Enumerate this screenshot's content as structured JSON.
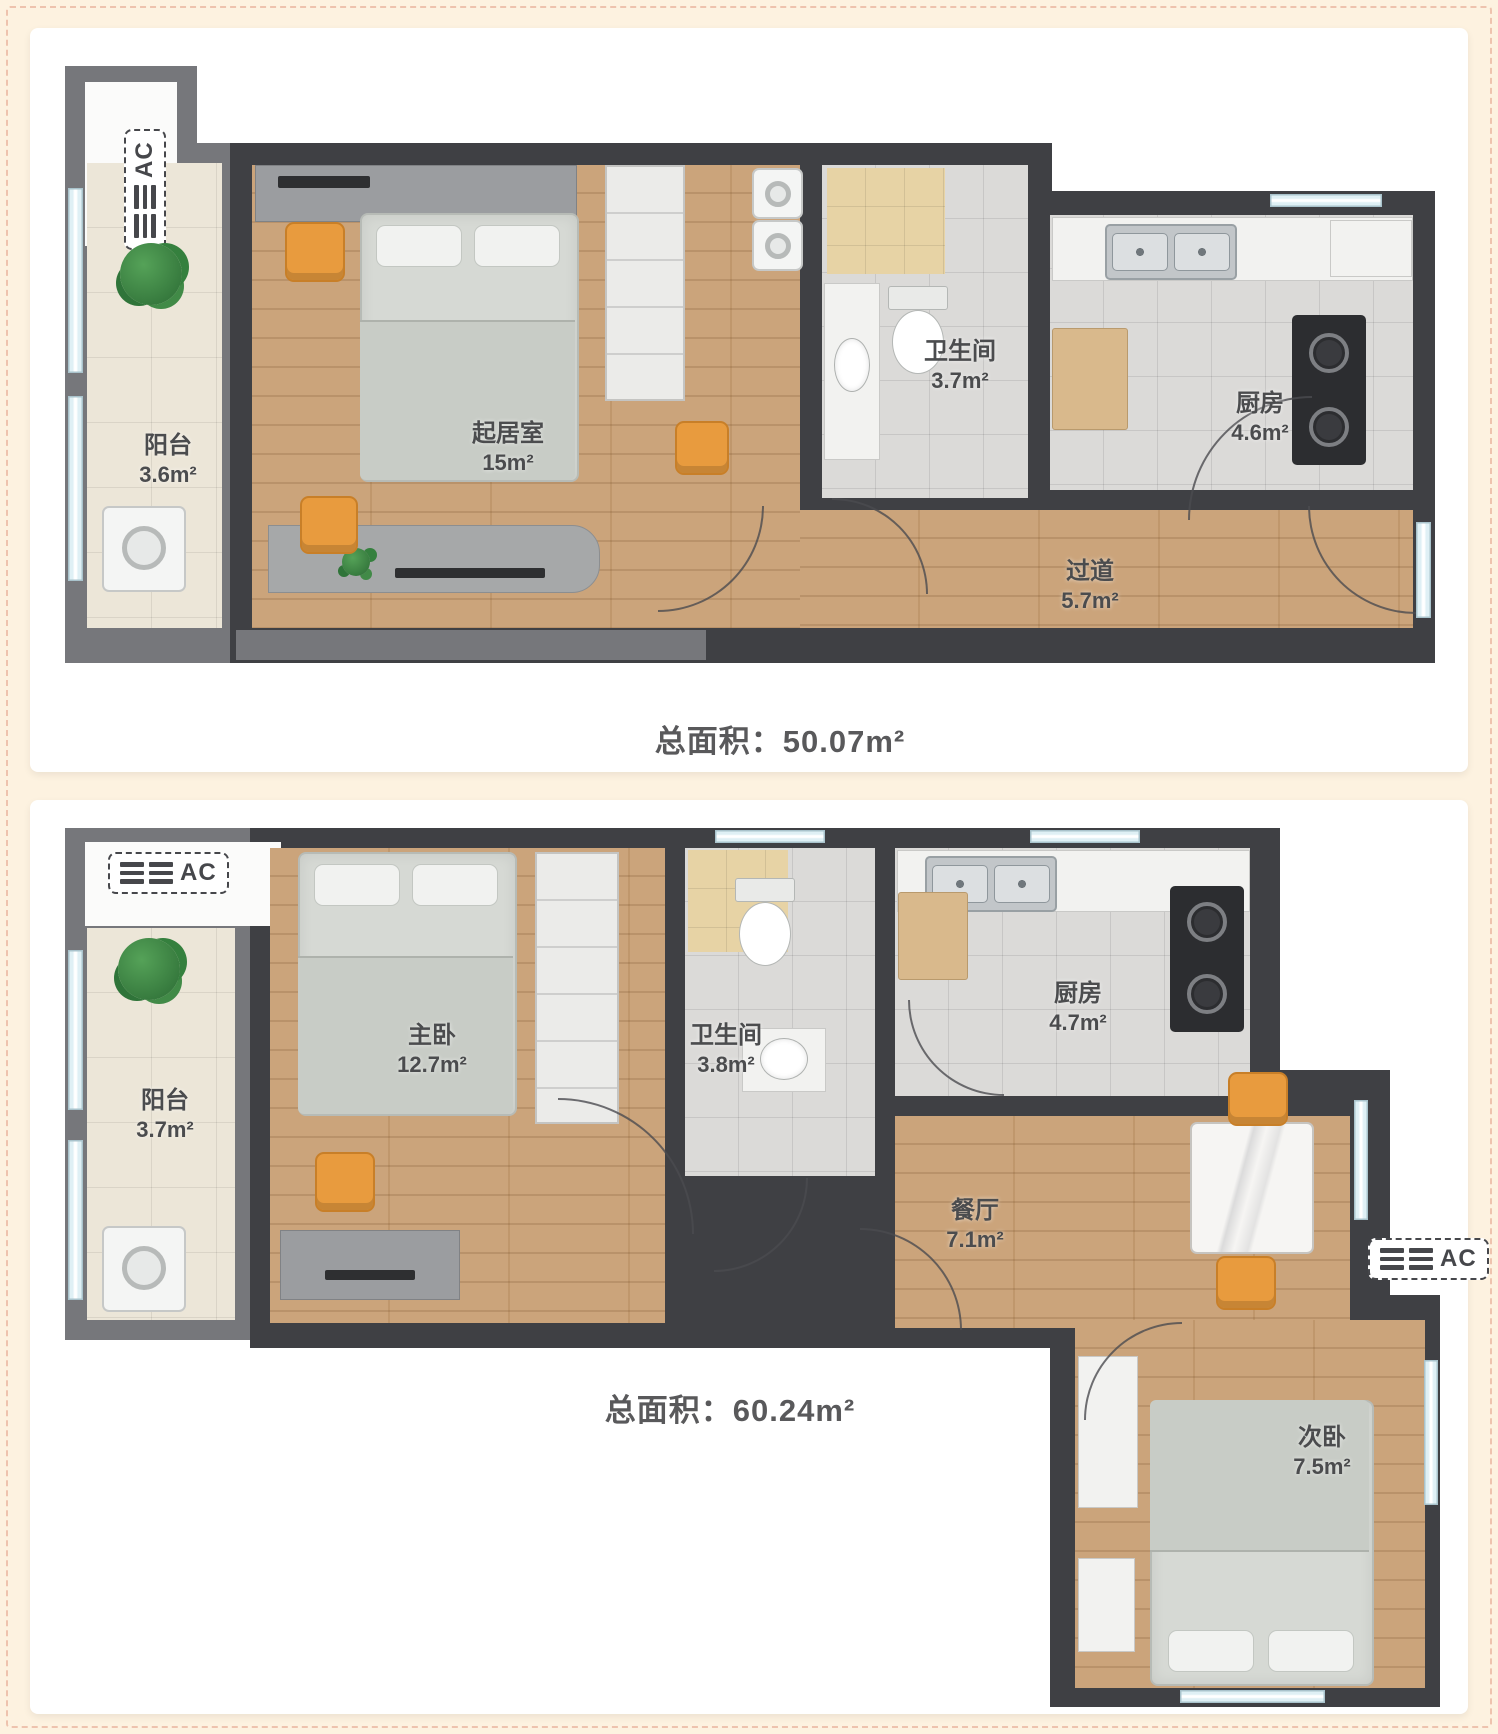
{
  "colors": {
    "page_bg": "#fdf2e0",
    "page_border_dash": "#eec3ae",
    "panel_bg": "#ffffff",
    "wall_dark": "#3f4044",
    "wall_mid": "#76777b",
    "wood_floor": "#c89f74",
    "tile_gray": "#dbdad8",
    "balcony_tile": "#ece6d8",
    "shower_beige": "#e7d3a5",
    "accent_orange": "#e89b3e",
    "plant_green": "#2f7a3c",
    "window_blue": "#dff0f5",
    "label_text": "#4b4c4e"
  },
  "plans": [
    {
      "total_label": "总面积：50.07m²",
      "ac_units": [
        {
          "label": "AC"
        }
      ],
      "rooms": [
        {
          "name": "阳台",
          "area": "3.6m²"
        },
        {
          "name": "起居室",
          "area": "15m²"
        },
        {
          "name": "卫生间",
          "area": "3.7m²"
        },
        {
          "name": "厨房",
          "area": "4.6m²"
        },
        {
          "name": "过道",
          "area": "5.7m²"
        }
      ]
    },
    {
      "total_label": "总面积：60.24m²",
      "ac_units": [
        {
          "label": "AC"
        },
        {
          "label": "AC"
        }
      ],
      "rooms": [
        {
          "name": "阳台",
          "area": "3.7m²"
        },
        {
          "name": "主卧",
          "area": "12.7m²"
        },
        {
          "name": "卫生间",
          "area": "3.8m²"
        },
        {
          "name": "厨房",
          "area": "4.7m²"
        },
        {
          "name": "餐厅",
          "area": "7.1m²"
        },
        {
          "name": "次卧",
          "area": "7.5m²"
        }
      ]
    }
  ]
}
